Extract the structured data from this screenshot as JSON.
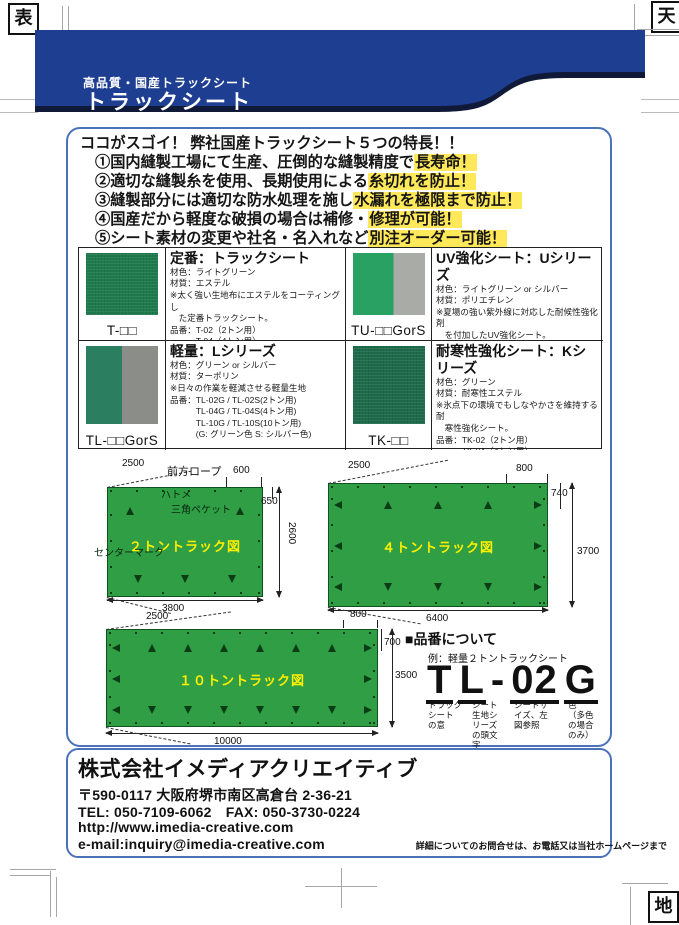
{
  "corner_marks": {
    "front": "表",
    "top": "天",
    "bottom": "地"
  },
  "banner": {
    "subtitle": "高品質・国産トラックシート",
    "title": "トラックシート"
  },
  "features": {
    "heading": "ココがスゴイ！ 弊社国産トラックシート５つの特長！！",
    "items": [
      {
        "text": "①国内縫製工場にて生産、圧倒的な縫製精度で",
        "highlight": "長寿命！"
      },
      {
        "text": "②適切な縫製糸を使用、長期使用による",
        "highlight": "糸切れを防止！"
      },
      {
        "text": "③縫製部分には適切な防水処理を施し",
        "highlight": "水漏れを極限まで防止！"
      },
      {
        "text": "④国産だから軽度な破損の場合は補修・",
        "highlight": "修理が可能！"
      },
      {
        "text": "⑤シート素材の変更や社名・名入れなど",
        "highlight": "別注オーダー可能！"
      }
    ]
  },
  "products": [
    {
      "code": "T-□□",
      "title": "定番：トラックシート",
      "body": "材色：ライトグリーン\n材質：エステル\n※太く強い生地布にエステルをコーティングし\n　た定番トラックシート。\n品番：T-02（2トン用）\n　　　T-04（4トン用）\n　　　T-10（10トン用）"
    },
    {
      "code": "TU-□□GorS",
      "title": "UV強化シート：Uシリーズ",
      "body": "材色：ライトグリーン or シルバー\n材質：ポリエチレン\n※夏場の強い紫外線に対応した耐候性強化剤\n　を付加したUV強化シート。\n品番：TU-02G / TU-02S(2トン用)\n　　　TU-04G / TU-04S(4トン用)\n　　　TU-10G / TU-10S(10トン用)\n　　　(G: グリーン色  S: シルバー色)"
    },
    {
      "code": "TL-□□GorS",
      "title": "軽量：Lシリーズ",
      "body": "材色：グリーン or シルバー\n材質：ターポリン\n※日々の作業を軽減させる軽量生地\n品番：TL-02G / TL-02S(2トン用)\n　　　TL-04G / TL-04S(4トン用)\n　　　TL-10G / TL-10S(10トン用)\n　　　(G: グリーン色  S: シルバー色)"
    },
    {
      "code": "TK-□□",
      "title": "耐寒性強化シート：Kシリーズ",
      "body": "材色：グリーン\n材質：耐寒性エステル\n※氷点下の環境でもしなやかさを維持する耐\n　寒性強化シート。\n品番：TK-02（2トン用）\n　　　TK-04（4トン用）\n　　　TK-10（10トン用）"
    }
  ],
  "diagrams": [
    {
      "title": "２トントラック図",
      "labels": {
        "rope": "前方ロープ",
        "grommet": "ハトメ",
        "pocket": "三角ペケット",
        "center_mark": "センターマーク"
      },
      "dims": {
        "diag_top": "2500",
        "top_right": "600",
        "right_upper": "650",
        "right_full": "2600",
        "bottom": "3800"
      }
    },
    {
      "title": "４トントラック図",
      "dims": {
        "diag_top": "2500",
        "top_right": "800",
        "right_upper": "740",
        "right_full": "3700",
        "bottom": "6400"
      }
    },
    {
      "title": "１０トントラック図",
      "dims": {
        "diag_top": "2500",
        "top_right": "800",
        "right_upper": "700",
        "right_full": "3500",
        "bottom": "10000"
      }
    }
  ],
  "part_number": {
    "heading": "■品番について",
    "example": "例：軽量２トントラックシート",
    "dash": "-",
    "segments": [
      {
        "chars": "T",
        "desc": "トラック\nシート\nの意"
      },
      {
        "chars": "L",
        "desc": "シート\n生地シ\nリーズ\nの頭文\n字"
      },
      {
        "chars": "02",
        "desc": "シートサ\nイズ、左\n図参照"
      },
      {
        "chars": "G",
        "desc": "色\n（多色\nの場合\nのみ）"
      }
    ]
  },
  "footer": {
    "company": "株式会社イメディアクリエイティブ",
    "address": "〒590-0117 大阪府堺市南区高倉台 2-36-21",
    "tel_fax": "TEL: 050-7109-6062　FAX: 050-3730-0224",
    "url": "http://www.imedia-creative.com",
    "email": "e-mail:inquiry@imedia-creative.com",
    "note": "詳細についてのお問合せは、お電話又は当社ホームページまで"
  },
  "colors": {
    "banner_blue": "#1e3e92",
    "banner_shadow": "#101a38",
    "box_border": "#4a72b8",
    "highlight_yellow": "#ffe85a",
    "sheet_green": "#2f9e45",
    "diagram_title_yellow": "#ffef00",
    "swatch_standard_green": "#1f7a4e",
    "swatch_uv_green": "#29a163",
    "swatch_silver": "#a9aca6",
    "swatch_light_green": "#2c7e60",
    "swatch_gray": "#8b8e88",
    "swatch_cold_green": "#1e6b4b"
  }
}
